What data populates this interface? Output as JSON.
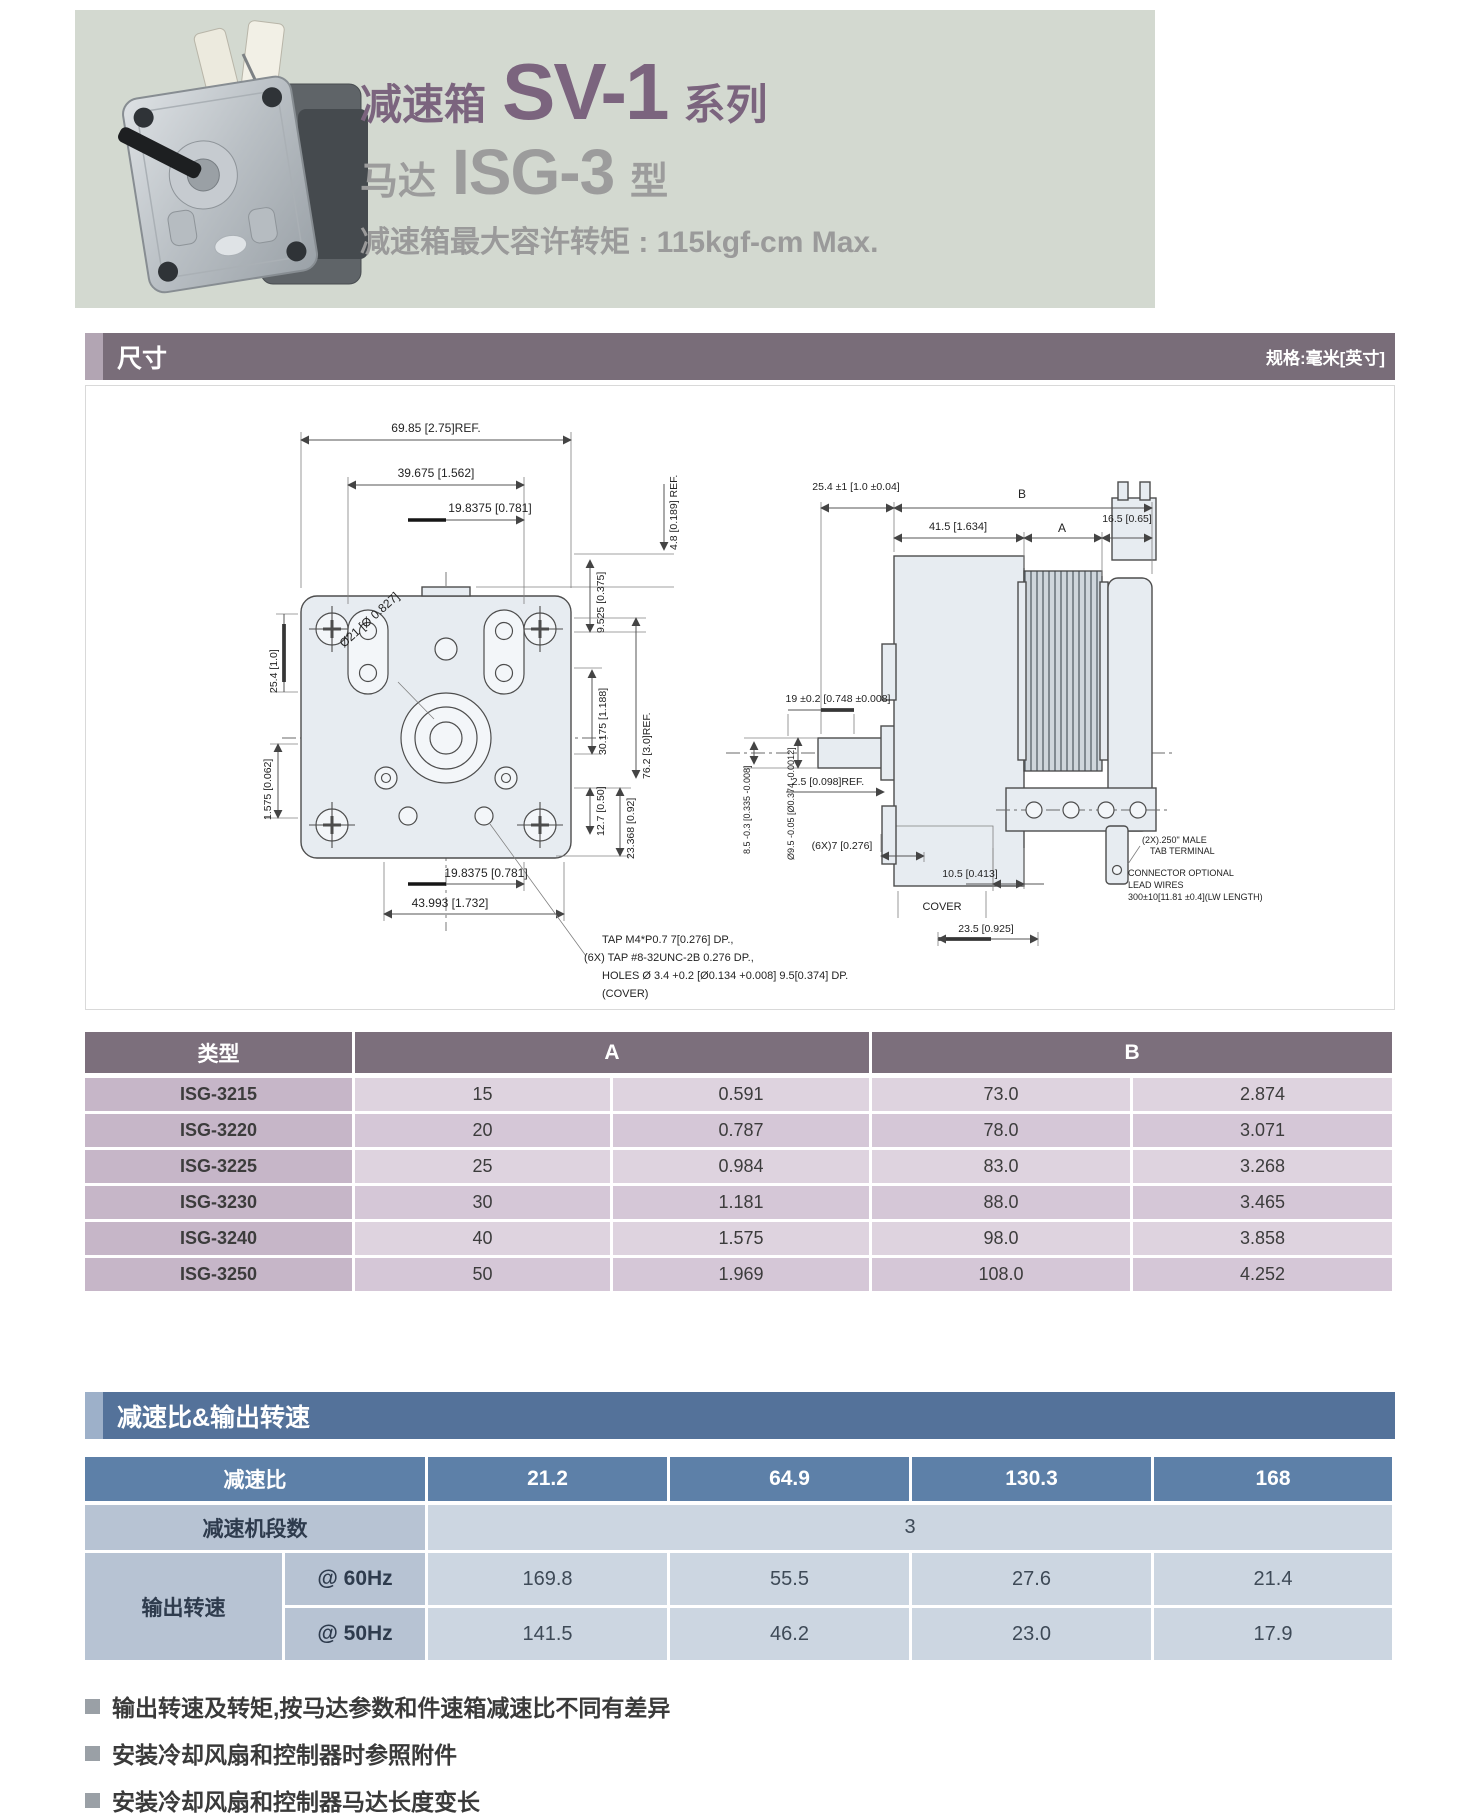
{
  "header": {
    "title_prefix": "减速箱",
    "title_model": "SV-1",
    "title_suffix": "系列",
    "subtitle_prefix": "马达",
    "subtitle_model": "ISG-3",
    "subtitle_suffix": "型",
    "torque_note": "减速箱最大容许转矩 : 115kgf-cm Max."
  },
  "section_dimensions": {
    "title": "尺寸",
    "unit_note": "规格:毫米[英寸]"
  },
  "drawing": {
    "front": {
      "dim_6985": "69.85 [2.75]REF.",
      "dim_39675": "39.675 [1.562]",
      "dim_198375_top": "19.8375 [0.781]",
      "dim_48": "4.8 [0.189] REF.",
      "dim_9525": "9.525 [0.375]",
      "dim_30175": "30.175 [1.188]",
      "dim_762": "76.2 [3.0]REF.",
      "dim_254": "25.4 [1.0]",
      "dim_1575": "1.575 [0.062]",
      "dim_dia21": "Ø21 [Ø 0.827]",
      "dim_198375_bottom": "19.8375 [0.781]",
      "dim_43993": "43.993 [1.732]",
      "dim_127": "12.7 [0.50]",
      "dim_23368": "23.368 [0.92]",
      "note_line1": "TAP M4*P0.7  7[0.276] DP.,",
      "note_line2": "(6X) TAP #8-32UNC-2B 0.276 DP.,",
      "note_line3": "HOLES Ø 3.4 +0.2 [Ø0.134 +0.008] 9.5[0.374] DP.",
      "note_line4": "(COVER)"
    },
    "side": {
      "dim_254t": "25.4 ±1 [1.0 ±0.04]",
      "dim_B": "B",
      "dim_415": "41.5 [1.634]",
      "dim_A": "A",
      "dim_165": "16.5 [0.65]",
      "dim_19": "19 ±0.2 [0.748 ±0.008]",
      "dim_25ref": "2.5 [0.098]REF.",
      "dim_6x7": "(6X)7 [0.276]",
      "dim_105": "10.5 [0.413]",
      "cover_label": "COVER",
      "dim_235": "23.5 [0.925]",
      "dim_dia95": "Ø9.5 -0.05 [Ø0.374 -0.0012]",
      "dim_85": "8.5 -0.3 [0.335 -0.008]",
      "tab_note": [
        "(2X).250\" MALE",
        "TAB TERMINAL"
      ],
      "conn_note": [
        "CONNECTOR OPTIONAL",
        "LEAD WIRES",
        "300±10[11.81 ±0.4](LW LENGTH)"
      ]
    }
  },
  "table_dimensions": {
    "col_type": "类型",
    "col_a": "A",
    "col_b": "B",
    "rows": [
      [
        "ISG-3215",
        "15",
        "0.591",
        "73.0",
        "2.874"
      ],
      [
        "ISG-3220",
        "20",
        "0.787",
        "78.0",
        "3.071"
      ],
      [
        "ISG-3225",
        "25",
        "0.984",
        "83.0",
        "3.268"
      ],
      [
        "ISG-3230",
        "30",
        "1.181",
        "88.0",
        "3.465"
      ],
      [
        "ISG-3240",
        "40",
        "1.575",
        "98.0",
        "3.858"
      ],
      [
        "ISG-3250",
        "50",
        "1.969",
        "108.0",
        "4.252"
      ]
    ]
  },
  "section_ratio": {
    "title": "减速比&输出转速"
  },
  "table_ratio": {
    "ratio_label": "减速比",
    "ratio_values": [
      "21.2",
      "64.9",
      "130.3",
      "168"
    ],
    "stages_label": "减速机段数",
    "stages_value": "3",
    "output_label": "输出转速",
    "output_rows": [
      {
        "freq": "@ 60Hz",
        "values": [
          "169.8",
          "55.5",
          "27.6",
          "21.4"
        ]
      },
      {
        "freq": "@ 50Hz",
        "values": [
          "141.5",
          "46.2",
          "23.0",
          "17.9"
        ]
      }
    ]
  },
  "footnotes": [
    "输出转速及转矩,按马达参数和件速箱减速比不同有差异",
    "安装冷却风扇和控制器时参照附件",
    "安装冷却风扇和控制器马达长度变长"
  ],
  "colors": {
    "hero_bg": "#d3d9d0",
    "title_purple": "#7b647e",
    "title_gray": "#9c9c9c",
    "section1_bar": "#796d79",
    "table1_header": "#7c6f7c",
    "table1_rowhead": "#c6b6c8",
    "table1_row_odd": "#ded3df",
    "table1_row_even": "#d5c7d7",
    "section2_bar": "#54729a",
    "table2_header": "#5d80a8",
    "table2_label": "#b7c3d3",
    "table2_cell": "#ccd6e1"
  }
}
